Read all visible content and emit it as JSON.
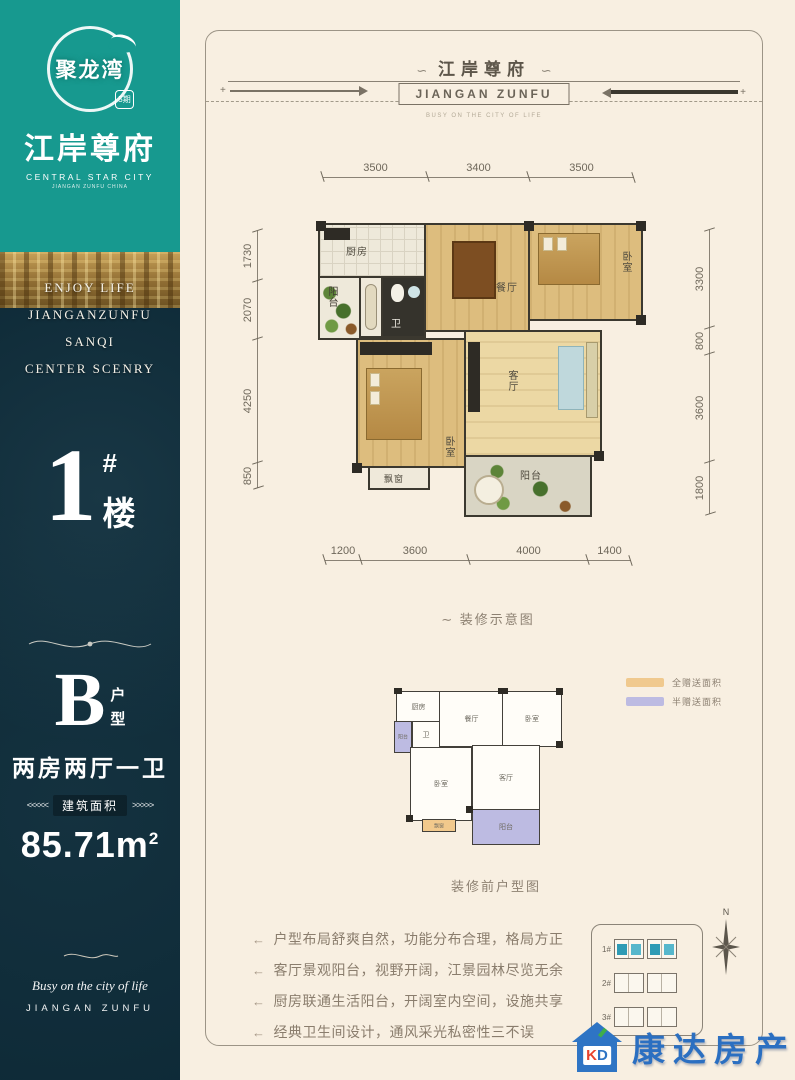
{
  "colors": {
    "teal": "#17998f",
    "navy": "#0e2a37",
    "cream": "#f8efe1",
    "legend_full": "#f0c98e",
    "legend_half": "#bdbbe2",
    "agency_blue": "#2b6fc1",
    "highlight_unit": "#2e9bb5"
  },
  "sidebar": {
    "logo_name": "聚龙湾",
    "logo_badge": "5期",
    "brand_cn": "江岸尊府",
    "brand_en": "CENTRAL STAR CITY",
    "brand_sub": "JIANGAN ZUNFU CHINA",
    "slogan_lines": {
      "0": "ENJOY LIFE",
      "1": "JIANGANZUNFU",
      "2": "SANQI",
      "3": "CENTER SCENRY"
    },
    "building_number": "1",
    "building_hash": "#",
    "building_suffix": "楼",
    "unit_letter": "B",
    "unit_type_char1": "户",
    "unit_type_char2": "型",
    "unit_desc": "两房两厅一卫",
    "area_arrows_left": "<<<<<",
    "area_label": "建筑面积",
    "area_arrows_right": ">>>>>",
    "area_value": "85.71m",
    "area_sup": "2",
    "footer_script": "Busy on the city of life",
    "footer_en": "JIANGAN ZUNFU"
  },
  "header": {
    "ornament_left": "∽",
    "title": "江岸尊府",
    "ornament_right": "∽",
    "subtitle_box": "JIANGAN ZUNFU",
    "tagline": "BUSY ON THE CITY OF LIFE",
    "plus": "+"
  },
  "decorated_plan": {
    "caption_marker": "∼ ",
    "caption": "装修示意图",
    "dims": {
      "top": {
        "0": "3500",
        "1": "3400",
        "2": "3500"
      },
      "left": {
        "0": "1730",
        "1": "2070",
        "2": "4250",
        "3": "850"
      },
      "right": {
        "0": "3300",
        "1": "800",
        "2": "3600",
        "3": "1800"
      },
      "bottom": {
        "0": "1200",
        "1": "3600",
        "2": "4000",
        "3": "1400"
      }
    },
    "rooms": {
      "kitchen": "厨房",
      "balcony_left": "阳台",
      "bath": "卫",
      "dining": "餐厅",
      "bedroom_right": "卧室",
      "bedroom_left": "卧室",
      "living": "客厅",
      "bay_window": "飘窗",
      "balcony_bottom": "阳台"
    }
  },
  "original_plan": {
    "caption": "装修前户型图",
    "rooms": {
      "kitchen": "厨房",
      "dining": "餐厅",
      "bedroom_right": "卧室",
      "balcony_left": "阳台",
      "bath": "卫",
      "bedroom_left": "卧室",
      "living": "客厅",
      "bay_window": "飘窗",
      "balcony_bottom": "阳台"
    },
    "legend": {
      "full": {
        "label": "全赠送面积",
        "color": "#f0c98e"
      },
      "half": {
        "label": "半赠送面积",
        "color": "#bdbbe2"
      }
    }
  },
  "features": {
    "marker": "←",
    "0": "户型布局舒爽自然，功能分布合理，格局方正",
    "1": "客厅景观阳台，视野开阔，江景园林尽览无余",
    "2": "厨房联通生活阳台，开阔室内空间，设施共享",
    "3": "经典卫生间设计，通风采光私密性三不误"
  },
  "siteplan": {
    "compass": "N",
    "buildings": {
      "0": "1#",
      "1": "2#",
      "2": "3#"
    }
  },
  "agency": {
    "logo_k": "K",
    "logo_d": "D",
    "name": "康达房产"
  }
}
